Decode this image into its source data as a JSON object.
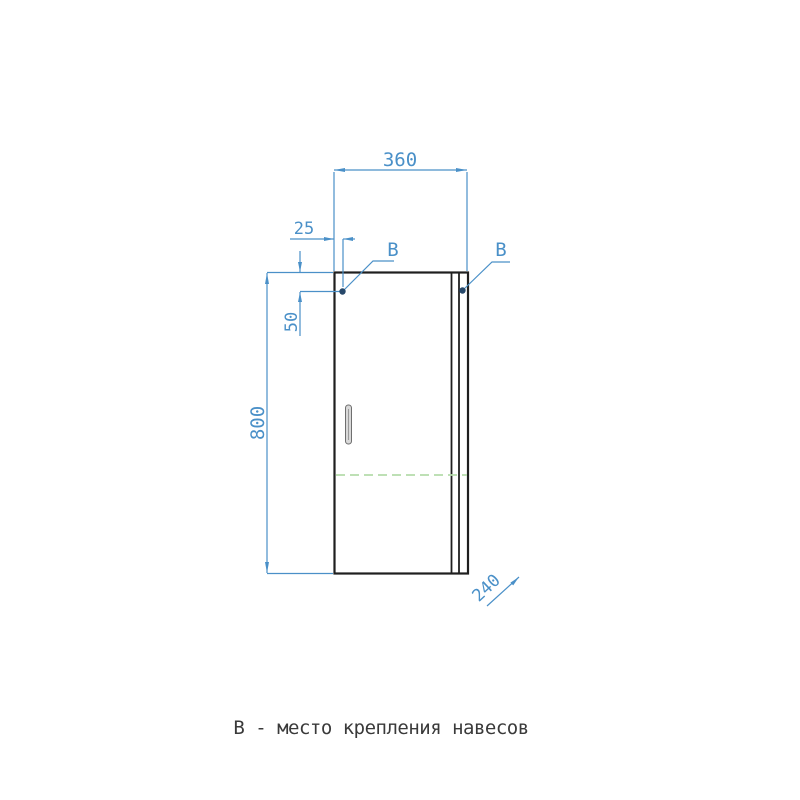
{
  "drawing": {
    "caption": "В - место крепления навесов",
    "dimensions": {
      "width": "360",
      "hinge_inset": "25",
      "hinge_drop": "50",
      "height": "800",
      "depth": "240"
    },
    "hinge_labels": {
      "left": "B",
      "right": "B"
    },
    "colors": {
      "dimension_blue": "#4a90c8",
      "hinge_dot_blue": "#27486a",
      "outline_black": "#1f1f1f",
      "shelf_dash_green": "#b5dcab",
      "caption_gray": "#3a3a3a",
      "background": "#ffffff"
    }
  }
}
